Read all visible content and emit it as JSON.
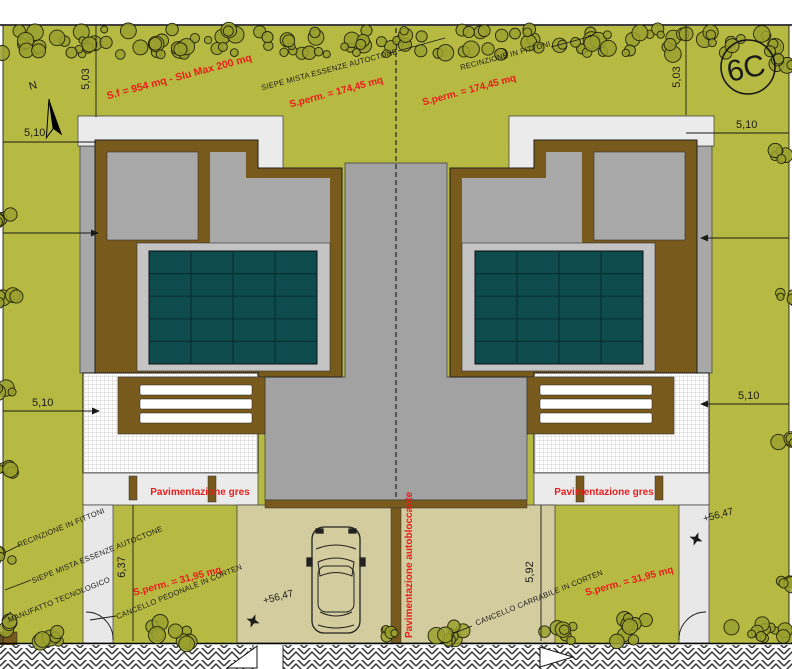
{
  "sheet": {
    "code": "6C"
  },
  "compass": {
    "label": "N"
  },
  "annotations": {
    "area_lot": "S.f = 954 mq - Slu Max 200 mq",
    "perm_main": "S.perm. = 174,45 mq",
    "perm_front": "S.perm. = 31,95 mq",
    "hedge": "SIEPE MISTA ESSENZE AUTOCTONE",
    "fence": "RECINZIONE IN FITTONI",
    "tech_unit": "MANUFATTO TECNOLOGICO",
    "gate_pedestrian": "CANCELLO PEDONALE IN CORTEN",
    "gate_driveway": "CANCELLO CARRABILE IN CORTEN",
    "paving_gres": "Pavimentazione gres",
    "paving_interlocking": "Pavimentazione autobloccante",
    "spot_elevation": "+56,47"
  },
  "dimensions": {
    "plot_top": "5,03",
    "plot_side": "5,10",
    "front_garden_left": "6,37",
    "front_garden_right": "5,92"
  },
  "colors": {
    "garden": "#b6ba42",
    "foliage": "#9aa02e",
    "roof-gray": "#a8a8a8",
    "court-gray": "#a2a2a2",
    "panel-margin": "#c4c4c4",
    "wood-brown": "#775a1c",
    "solar-teal": "#0d4b4e",
    "drive-beige": "#d3cc9e",
    "pave-white": "#ebebeb",
    "annotation-red": "#e81e1c",
    "ink": "#1a1a1a"
  }
}
